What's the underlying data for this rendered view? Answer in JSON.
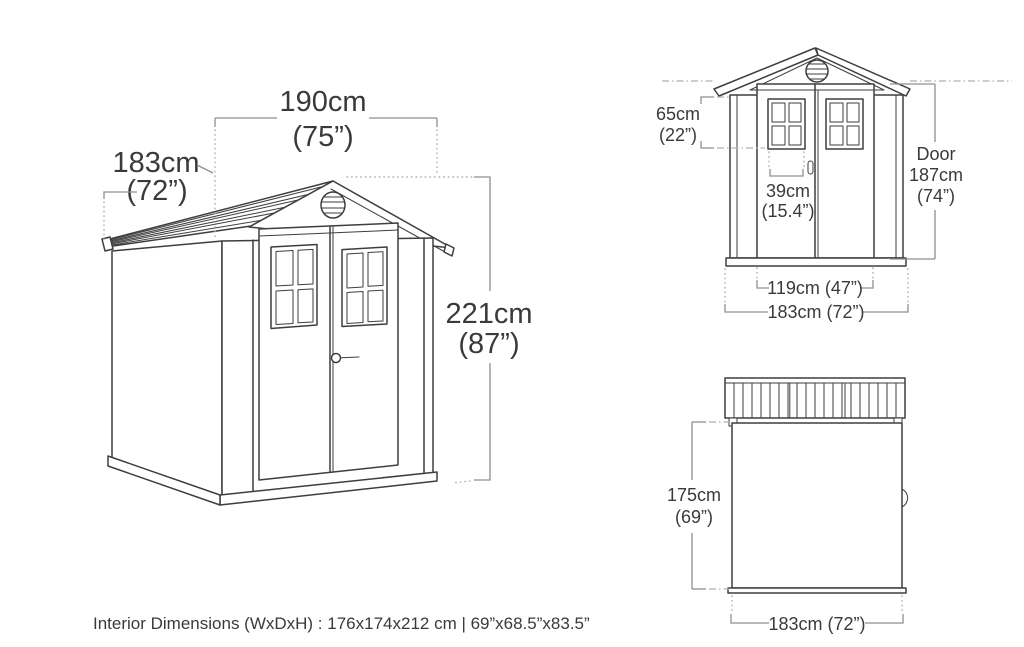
{
  "colors": {
    "line": "#3e3e3e",
    "dim_line": "#8f8f8f",
    "guide_line": "#b0b0b0",
    "text": "#3a3a3a",
    "background": "#ffffff"
  },
  "main_view": {
    "title": "shed perspective drawing",
    "width": {
      "cm": "190cm",
      "in": "(75”)"
    },
    "depth": {
      "cm": "183cm",
      "in": "(72”)"
    },
    "height": {
      "cm": "221cm",
      "in": "(87”)"
    }
  },
  "front_view": {
    "title": "shed front elevation",
    "gable_height": {
      "cm": "65cm",
      "in": "(22”)"
    },
    "window_width": {
      "cm": "39cm",
      "in": "(15.4”)"
    },
    "door_height": {
      "label": "Door",
      "cm": "187cm",
      "in": "(74”)"
    },
    "door_width": "119cm (47”)",
    "overall_width": "183cm (72”)"
  },
  "top_view": {
    "title": "shed top plan",
    "depth": {
      "cm": "175cm",
      "in": "(69”)"
    },
    "width": "183cm (72”)"
  },
  "footer": {
    "interior_dimensions": "Interior Dimensions (WxDxH) : 176x174x212 cm | 69”x68.5”x83.5”"
  }
}
